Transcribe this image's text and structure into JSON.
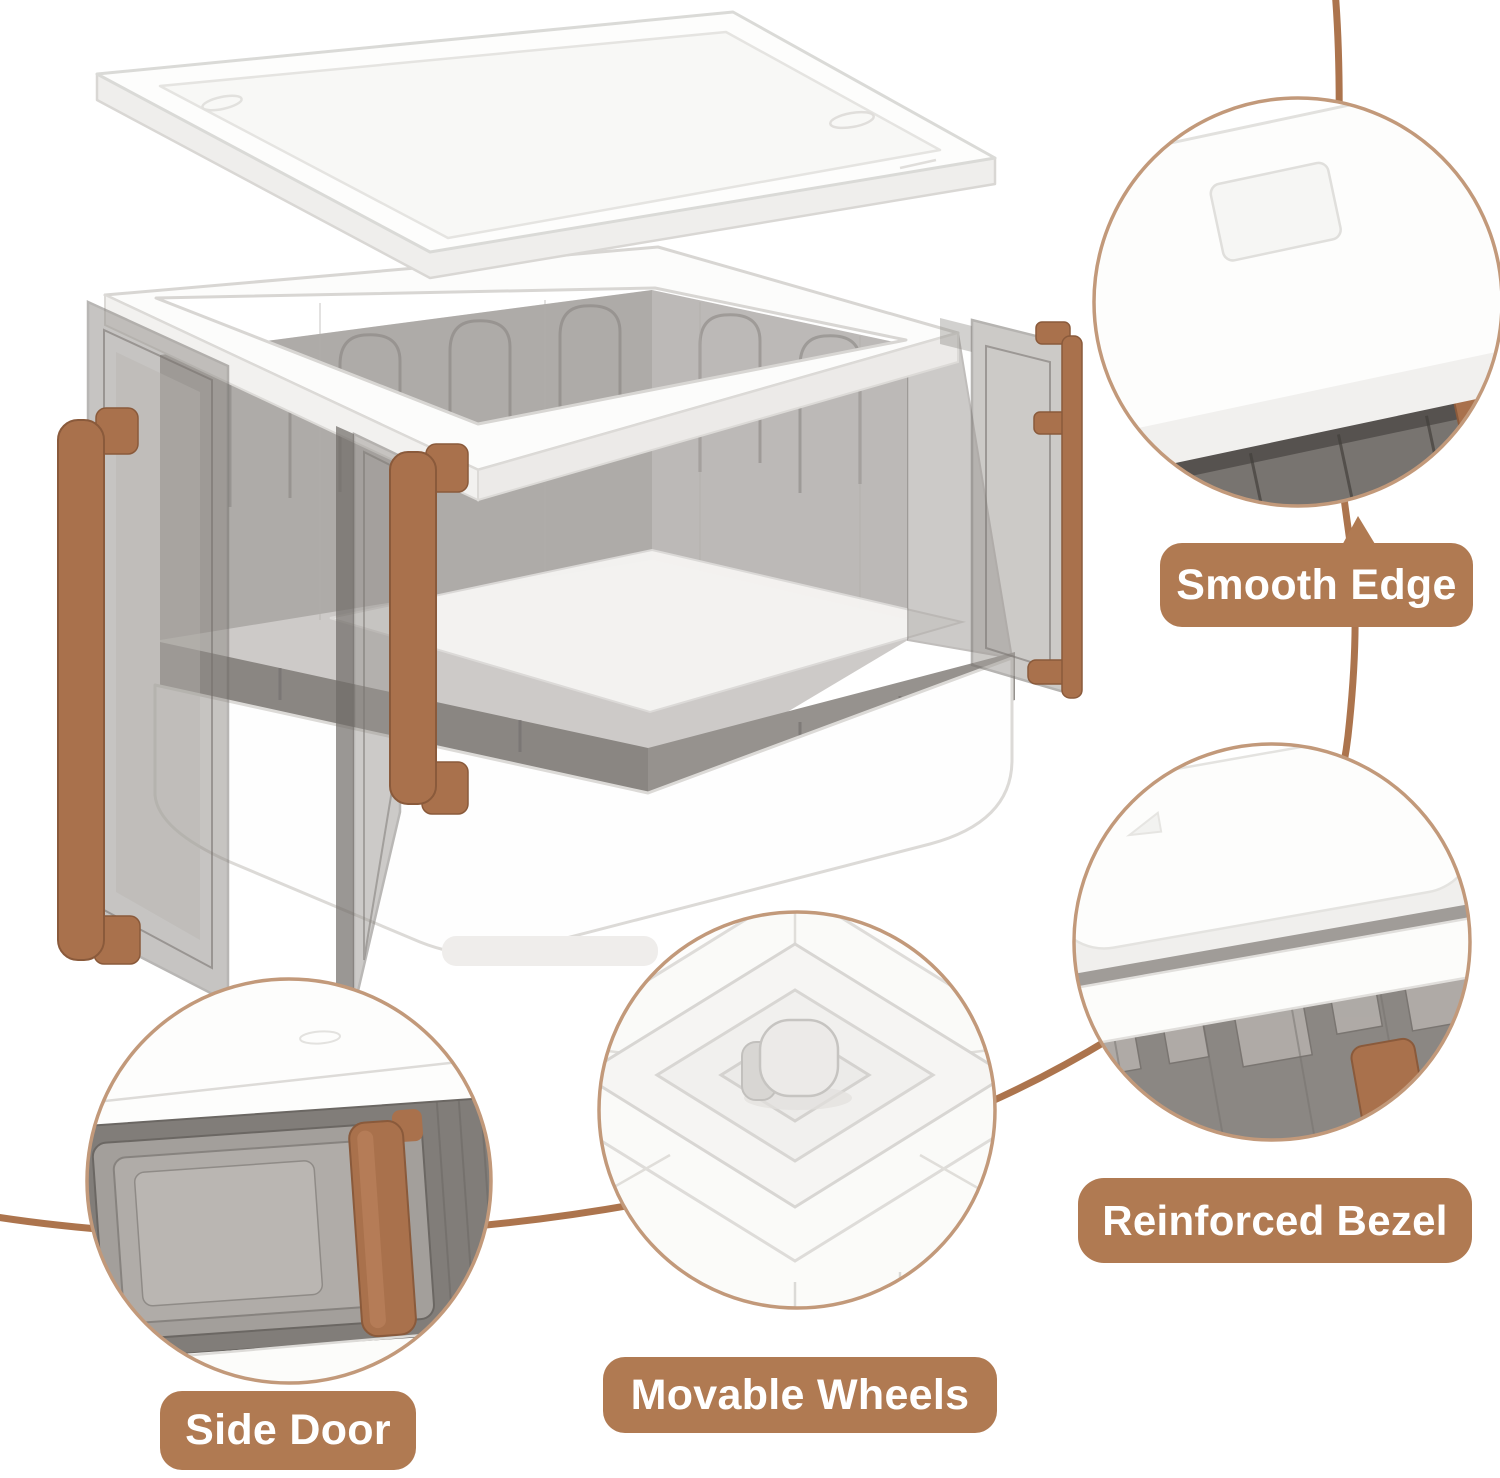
{
  "infographic": {
    "background": "#ffffff",
    "accent_brown": "#b07a52",
    "connector_line_color": "#ac744d",
    "callout_ring_color": "#c2997a",
    "handle_brown": "#a9714c",
    "panel_smoke": "#8d8985",
    "plastic_white": "#fdfdfc"
  },
  "product": {
    "kind": "collapsible-storage-box",
    "parts": [
      "lid",
      "box-body",
      "left-door",
      "front-door",
      "right-door",
      "door-handles",
      "base",
      "caster-wheel"
    ]
  },
  "callouts": [
    {
      "id": "smooth-edge",
      "label": "Smooth Edge"
    },
    {
      "id": "reinforced-bezel",
      "label": "Reinforced Bezel"
    },
    {
      "id": "movable-wheels",
      "label": "Movable Wheels"
    },
    {
      "id": "side-door",
      "label": "Side Door"
    }
  ]
}
